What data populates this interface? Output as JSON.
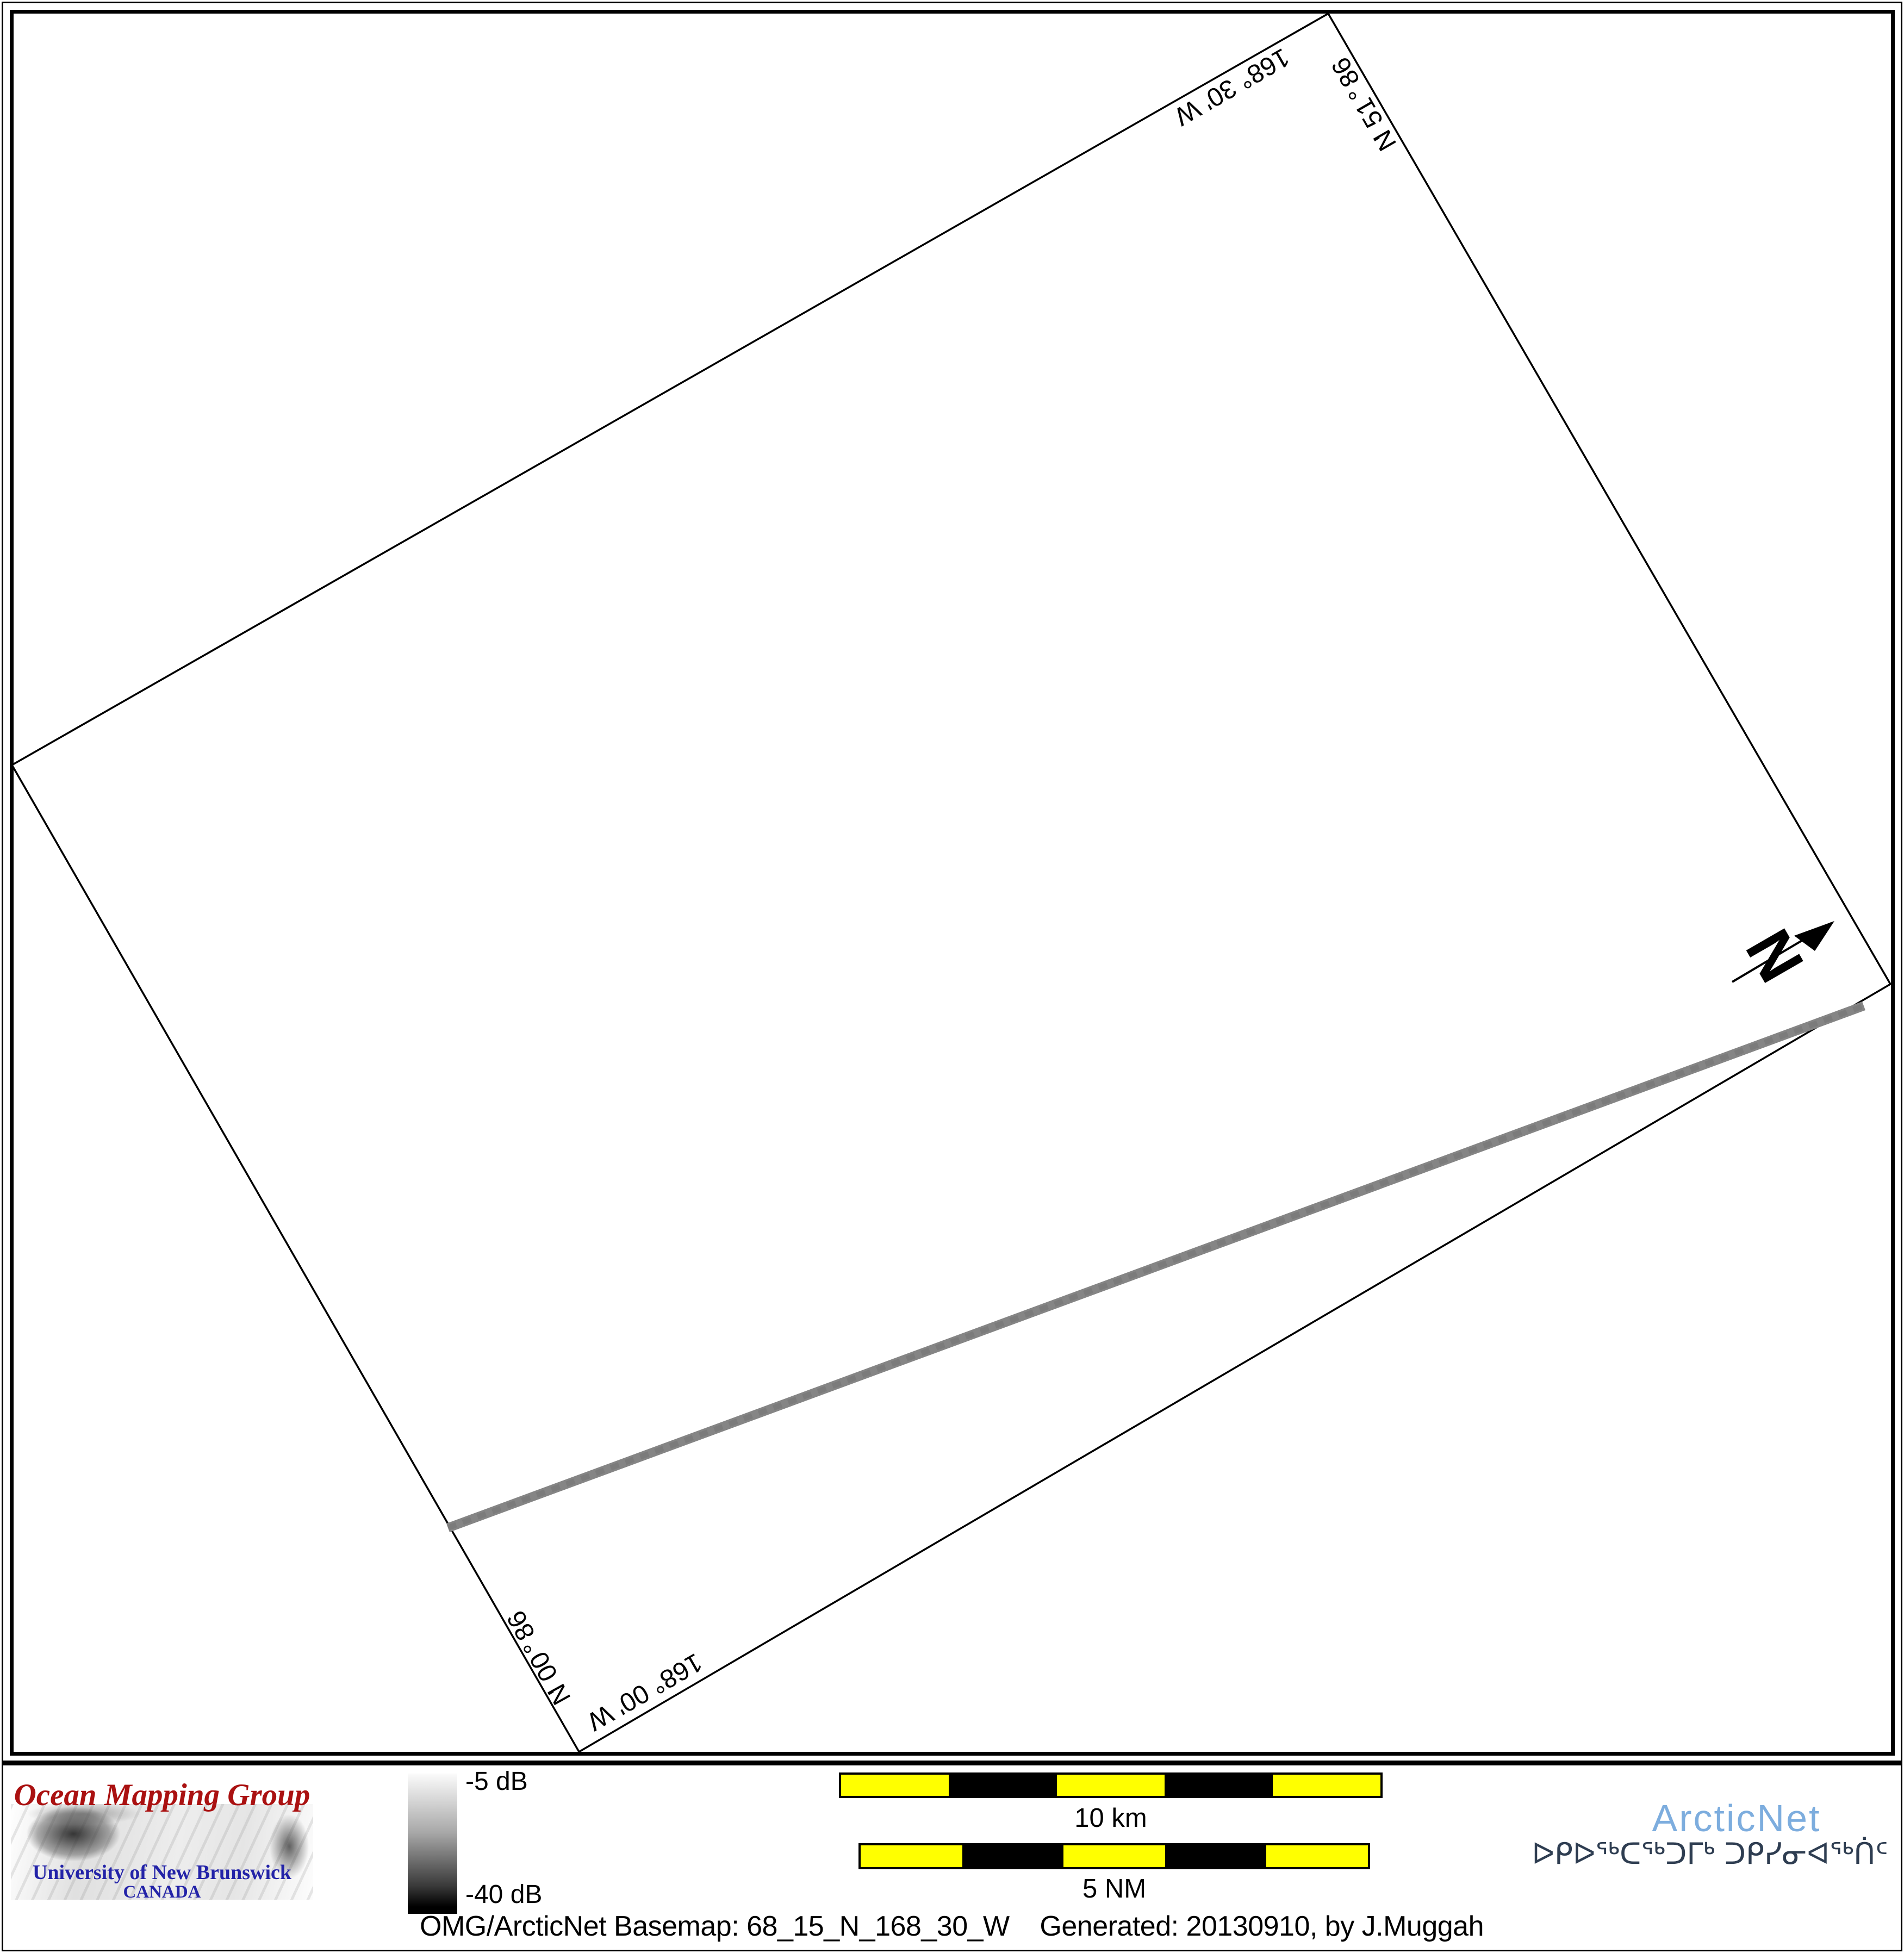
{
  "map": {
    "boundary_labels": {
      "top_lon": "168° 30' W",
      "right_lat": "68° 15' N",
      "left_lat": "68° 00' N",
      "bottom_lon": "168° 00' W"
    },
    "north_arrow_label": "N"
  },
  "legend": {
    "omg": {
      "title": "Ocean Mapping Group",
      "university": "University of New Brunswick",
      "country": "CANADA",
      "title_color": "#aa1111",
      "text_color": "#2323a8"
    },
    "colorbar": {
      "top_label": "-5 dB",
      "bottom_label": "-40 dB"
    },
    "scalebars": [
      {
        "label": "10 km"
      },
      {
        "label": "5 NM"
      }
    ],
    "caption": "OMG/ArcticNet Basemap: 68_15_N_168_30_W    Generated: 20130910, by J.Muggah",
    "arcticnet": {
      "name": "ArcticNet",
      "inuktitut": "ᐅᑭᐅᖅᑕᖅᑐᒥᒃ ᑐᑭᓯᓂᐊᖅᑏᑦ",
      "name_color": "#7dadde",
      "inuktitut_color": "#2e3d51"
    }
  },
  "colors": {
    "survey_outline": "#000000",
    "sonar_swath": "#858585",
    "scalebar_yellow": "#ffff00",
    "frame": "#000000"
  }
}
